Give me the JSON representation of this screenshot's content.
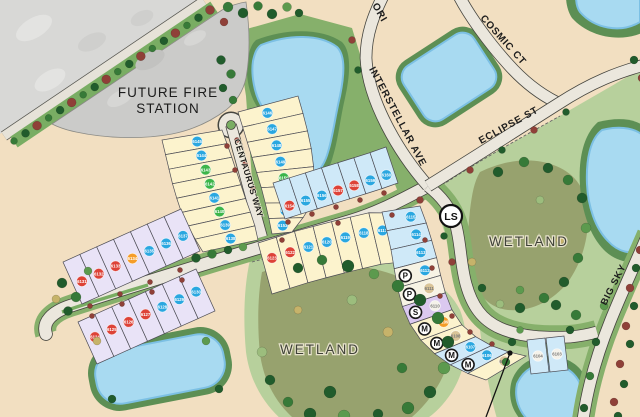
{
  "map_labels": {
    "future_fire_line1": "FUTURE FIRE",
    "future_fire_line2": "STATION",
    "wetland_center": "WETLAND",
    "wetland_right": "WETLAND",
    "lift_station": "LS"
  },
  "streets": {
    "centaurus": "CENTAURUS WAY",
    "interstellar": "INTERSTELLAR AVE",
    "cosmic": "COSMIC CT",
    "eclipse": "ECLIPSE ST",
    "orion_partial": "ORI",
    "big_sky": "BIG SKY"
  },
  "dot_colors": {
    "blue": "#2aa7e0",
    "green": "#3cb54a",
    "red": "#dd4237",
    "orange": "#f59d28",
    "tan": "#d9c498",
    "white": "#f5f2ea"
  },
  "lot_fill_colors": {
    "yellow": "#fcf3cd",
    "lightblue": "#cfe9f8",
    "lavender": "#e9e3f7",
    "cream": "#f7f3e4",
    "purple": "#dbc9f0"
  },
  "lot_groups": [
    {
      "id": "centaurus_west",
      "fill": "yellow",
      "lots": [
        {
          "n": "6145",
          "dot": "blue"
        },
        {
          "n": "6144",
          "dot": "blue"
        },
        {
          "n": "6143",
          "dot": "green"
        },
        {
          "n": "6142",
          "dot": "green"
        },
        {
          "n": "6141",
          "dot": "blue"
        },
        {
          "n": "6140",
          "dot": "green"
        },
        {
          "n": "6139",
          "dot": "blue"
        },
        {
          "n": "6138",
          "dot": "blue"
        }
      ]
    },
    {
      "id": "centaurus_east",
      "fill": "yellow",
      "lots": [
        {
          "n": "6146",
          "dot": "blue"
        },
        {
          "n": "6147",
          "dot": "blue"
        },
        {
          "n": "6148",
          "dot": "blue"
        },
        {
          "n": "6149",
          "dot": "blue"
        },
        {
          "n": "6150",
          "dot": "green"
        },
        {
          "n": "6151",
          "dot": "blue"
        },
        {
          "n": "6152",
          "dot": "blue"
        },
        {
          "n": "6153",
          "dot": "blue"
        }
      ]
    },
    {
      "id": "blue_row",
      "fill": "lightblue",
      "lots": [
        {
          "n": "6154",
          "dot": "red"
        },
        {
          "n": "6155",
          "dot": "blue"
        },
        {
          "n": "6156",
          "dot": "blue"
        },
        {
          "n": "6157",
          "dot": "red"
        },
        {
          "n": "6158",
          "dot": "red"
        },
        {
          "n": "6159",
          "dot": "blue"
        },
        {
          "n": "6160",
          "dot": "blue"
        }
      ]
    },
    {
      "id": "middle_row",
      "fill": "yellow",
      "lots": [
        {
          "n": "6123",
          "dot": "red"
        },
        {
          "n": "6122",
          "dot": "red"
        },
        {
          "n": "6121",
          "dot": "blue"
        },
        {
          "n": "6120",
          "dot": "blue"
        },
        {
          "n": "6119",
          "dot": "blue"
        },
        {
          "n": "6118",
          "dot": "blue"
        },
        {
          "n": "6117",
          "dot": "blue"
        },
        {
          "n": "6116",
          "dot": "blue"
        }
      ]
    },
    {
      "id": "lavender_upper",
      "fill": "lavender",
      "lots": [
        {
          "n": "6131",
          "dot": "red"
        },
        {
          "n": "6132",
          "dot": "red"
        },
        {
          "n": "6133",
          "dot": "red"
        },
        {
          "n": "6134",
          "dot": "orange"
        },
        {
          "n": "6135",
          "dot": "blue"
        },
        {
          "n": "6136",
          "dot": "blue"
        },
        {
          "n": "6137",
          "dot": "blue"
        }
      ]
    },
    {
      "id": "lavender_lower",
      "fill": "lavender",
      "lots": [
        {
          "n": "6124",
          "dot": "red"
        },
        {
          "n": "6125",
          "dot": "red"
        },
        {
          "n": "6126",
          "dot": "red"
        },
        {
          "n": "6127",
          "dot": "red"
        },
        {
          "n": "6128",
          "dot": "blue"
        },
        {
          "n": "6129",
          "dot": "blue"
        },
        {
          "n": "6130",
          "dot": "blue"
        }
      ]
    },
    {
      "id": "right_column",
      "lots": [
        {
          "n": "6115",
          "fill": "lightblue",
          "dot": "blue"
        },
        {
          "n": "6114",
          "fill": "lightblue",
          "dot": "blue"
        },
        {
          "n": "6113",
          "fill": "lightblue",
          "dot": "blue"
        },
        {
          "n": "6112",
          "fill": "cream",
          "dot": "blue",
          "badge": "P"
        },
        {
          "n": "6111",
          "fill": "cream",
          "dot": "tan",
          "badge": "P"
        },
        {
          "n": "6110",
          "fill": "purple",
          "dot": "white",
          "badge": "S"
        },
        {
          "n": "6109",
          "fill": "yellow",
          "dot": "orange",
          "badge": "M"
        },
        {
          "n": "6108",
          "fill": "yellow",
          "dot": "tan",
          "badge": "M"
        },
        {
          "n": "6107",
          "fill": "lightblue",
          "dot": "blue",
          "badge": "M"
        },
        {
          "n": "6106",
          "fill": "lightblue",
          "dot": "blue",
          "badge": "M"
        },
        {
          "n": "6105",
          "fill": "yellow",
          "dot": "tan"
        }
      ]
    },
    {
      "id": "east_pair",
      "fill": "lightblue",
      "lots": [
        {
          "n": "6104",
          "dot": "white"
        },
        {
          "n": "6103",
          "dot": "white"
        }
      ]
    }
  ]
}
